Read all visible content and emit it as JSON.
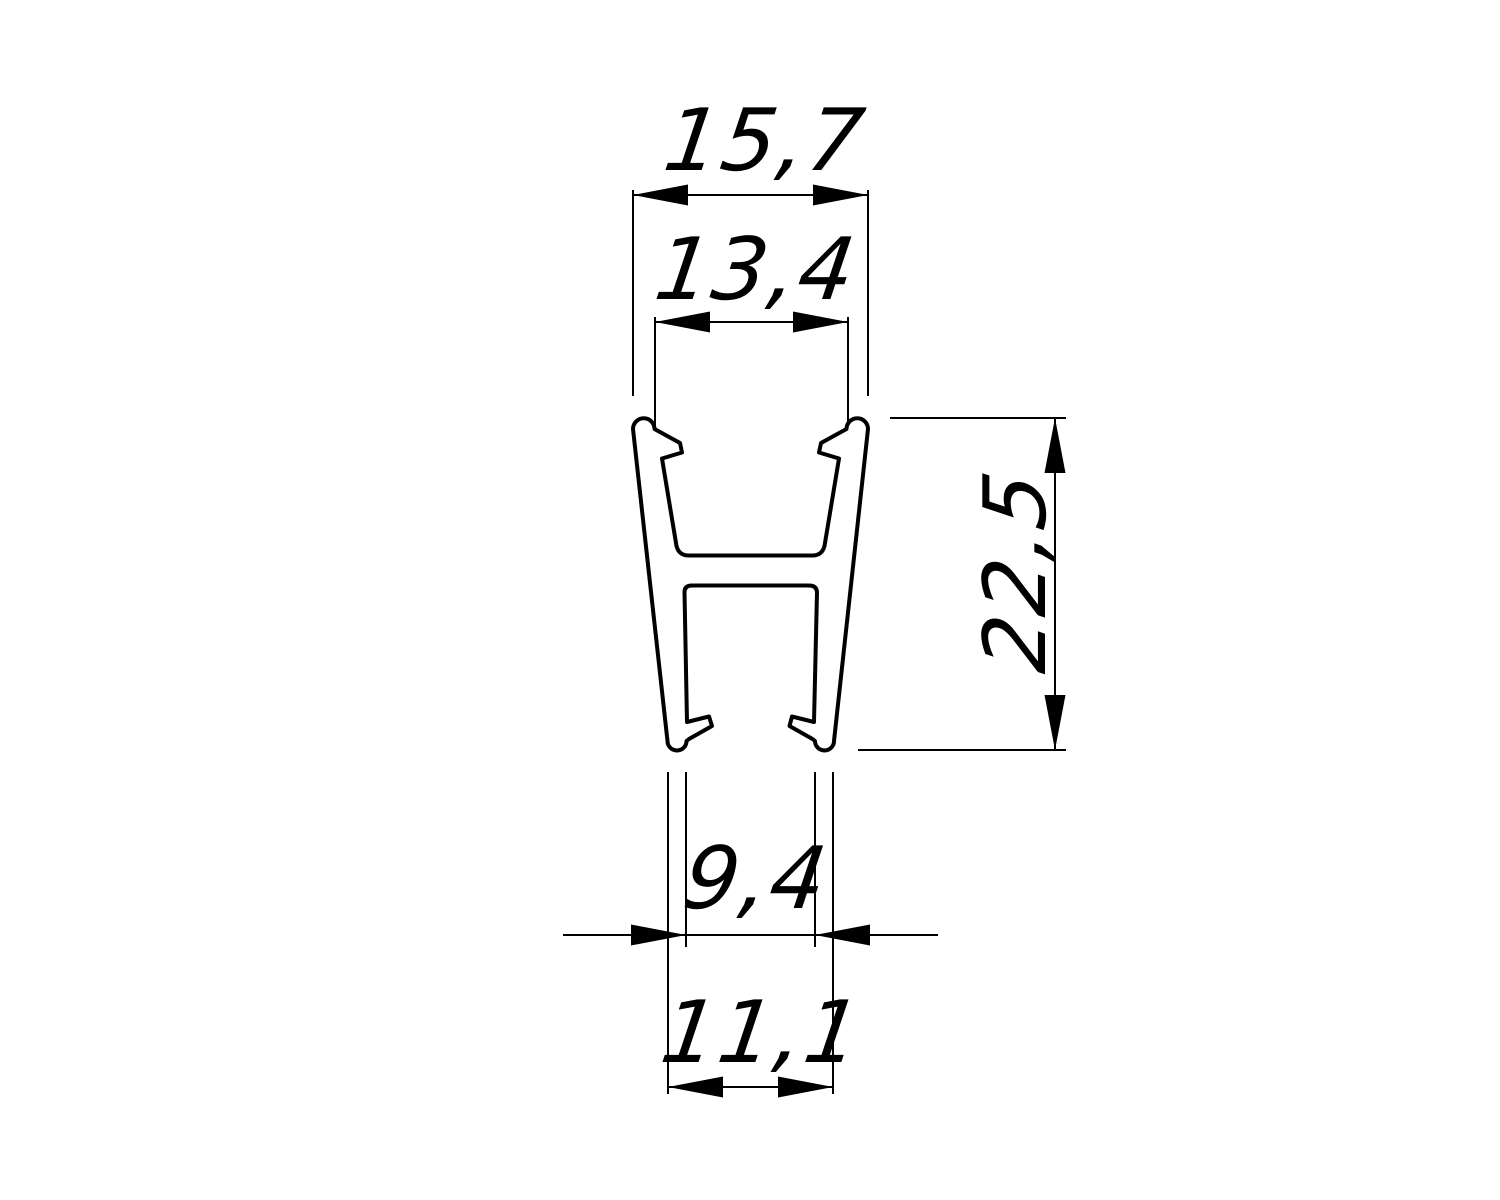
{
  "drawing": {
    "background_color": "#ffffff",
    "line_color": "#000000",
    "dimension_labels": {
      "top_outer_width": "15,7",
      "top_inner_width": "13,4",
      "overall_height": "22,5",
      "bottom_inner_width": "9,4",
      "bottom_outer_width": "11,1"
    }
  }
}
